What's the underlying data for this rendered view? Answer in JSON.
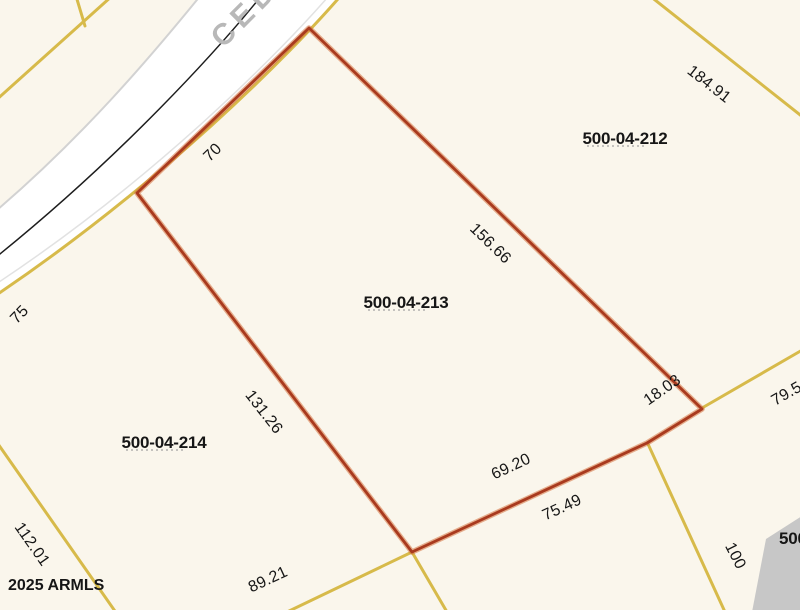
{
  "road": {
    "name": "CED"
  },
  "watermark": "2025 ARMLS",
  "colors": {
    "bg": "#faf6ec",
    "parcel_line": "#d7ba4a",
    "selected_line": "#a93a1e",
    "selected_glow": "#d3703c",
    "road_fill": "#ffffff",
    "road_edge": "#d2d2d2",
    "centerline": "#1d1d1d",
    "label": "#161616",
    "road_label": "#b8b8b8",
    "building": "#c7c7c7",
    "underline": "#8f8f8f"
  },
  "selected_parcel_apn": "500-04-213",
  "parcel_labels": [
    {
      "apn": "500-04-212",
      "x": 625,
      "y": 139,
      "underline": true
    },
    {
      "apn": "500-04-213",
      "x": 406,
      "y": 303,
      "underline": true
    },
    {
      "apn": "500-04-214",
      "x": 164,
      "y": 443,
      "underline": true
    },
    {
      "apn": "500",
      "x": 779,
      "y": 539,
      "underline": false,
      "anchor": "start"
    }
  ],
  "dimension_labels": [
    {
      "text": "70",
      "x": 216,
      "y": 156,
      "rot": -44
    },
    {
      "text": "156.66",
      "x": 487,
      "y": 247,
      "rot": 44
    },
    {
      "text": "184.91",
      "x": 706,
      "y": 88,
      "rot": 38
    },
    {
      "text": "75",
      "x": 23,
      "y": 318,
      "rot": -46
    },
    {
      "text": "131.26",
      "x": 260,
      "y": 415,
      "rot": 52
    },
    {
      "text": "18.03",
      "x": 665,
      "y": 394,
      "rot": -35
    },
    {
      "text": "69.20",
      "x": 513,
      "y": 471,
      "rot": -25
    },
    {
      "text": "75.49",
      "x": 564,
      "y": 512,
      "rot": -25
    },
    {
      "text": "89.21",
      "x": 270,
      "y": 584,
      "rot": -25
    },
    {
      "text": "112.01",
      "x": 28,
      "y": 547,
      "rot": 55
    },
    {
      "text": "100",
      "x": 731,
      "y": 558,
      "rot": 63
    },
    {
      "text": "79.5",
      "x": 789,
      "y": 398,
      "rot": -30
    }
  ]
}
